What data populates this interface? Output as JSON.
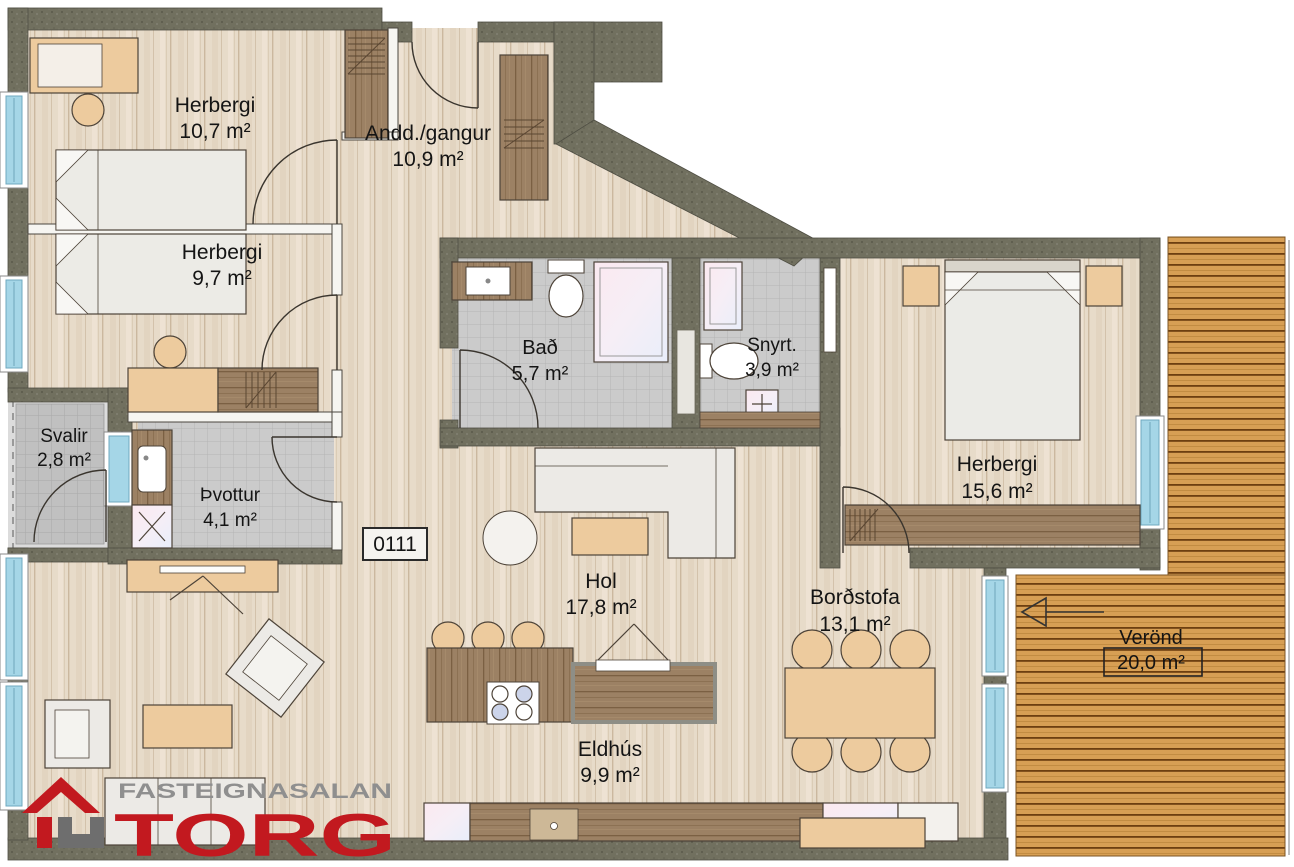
{
  "floorplan": {
    "unit_number": "0111",
    "rooms": [
      {
        "id": "herbergi-1",
        "name": "Herbergi",
        "area": "10,7 m²"
      },
      {
        "id": "anddyri",
        "name": "Andd./gangur",
        "area": "10,9 m²"
      },
      {
        "id": "herbergi-2",
        "name": "Herbergi",
        "area": "9,7 m²"
      },
      {
        "id": "svalir",
        "name": "Svalir",
        "area": "2,8 m²"
      },
      {
        "id": "thvottur",
        "name": "Þvottur",
        "area": "4,1 m²"
      },
      {
        "id": "bad",
        "name": "Bað",
        "area": "5,7 m²"
      },
      {
        "id": "snyrt",
        "name": "Snyrt.",
        "area": "3,9 m²"
      },
      {
        "id": "herbergi-3",
        "name": "Herbergi",
        "area": "15,6 m²"
      },
      {
        "id": "hol",
        "name": "Hol",
        "area": "17,8 m²"
      },
      {
        "id": "bordstofa",
        "name": "Borðstofa",
        "area": "13,1 m²"
      },
      {
        "id": "eldhus",
        "name": "Eldhús",
        "area": "9,9 m²"
      },
      {
        "id": "verond",
        "name": "Verönd",
        "area": "20,0 m²"
      }
    ],
    "logo": {
      "top": "FASTEIGNASALAN",
      "main": "TORG"
    },
    "colors": {
      "wall": "#71705f",
      "wood_floor": "#e7dbc9",
      "tile": "#cbcbcb",
      "deck": "#d79f54",
      "furniture_tan": "#edcb9e",
      "cabinet_wood": "#9c8164",
      "window_glass": "#a5d6e7",
      "logo_red": "#c2191f",
      "logo_gray": "#8f8f8f"
    }
  }
}
